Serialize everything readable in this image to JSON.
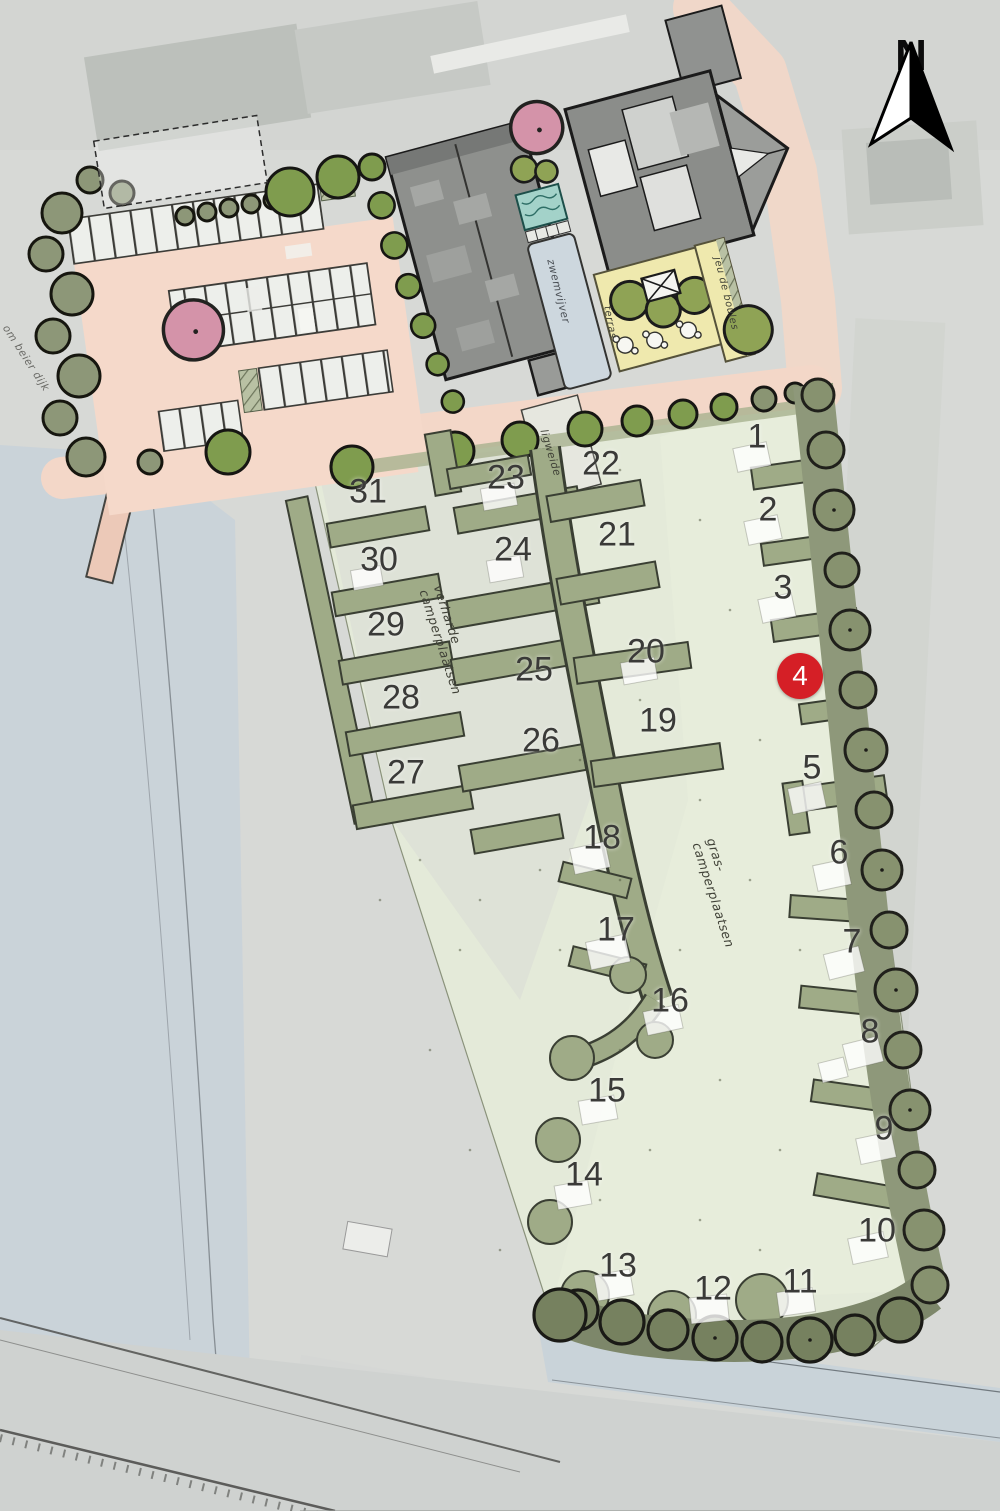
{
  "plan": {
    "compass_label": "N",
    "selected_pitch": "4",
    "pitch_numbers": [
      "1",
      "2",
      "3",
      "4",
      "5",
      "6",
      "7",
      "8",
      "9",
      "10",
      "11",
      "12",
      "13",
      "14",
      "15",
      "16",
      "17",
      "18",
      "19",
      "20",
      "21",
      "22",
      "23",
      "24",
      "25",
      "26",
      "27",
      "28",
      "29",
      "30",
      "31"
    ],
    "labels": {
      "grass_area_line1": "gras-",
      "grass_area_line2": "camperplaatsen",
      "paved_area_line1": "verharde",
      "paved_area_line2": "camperplaatsen",
      "pool": "zwemvijver",
      "lawn": "ligweide",
      "terrace": "terras",
      "petanque": "jeu de boules",
      "road": "om beier dijk"
    },
    "colors": {
      "marker_red": "#d51f26",
      "grass_field": "#e4ead9",
      "hedge_olive": "#9fab87",
      "boundary_olive": "#86916f",
      "tree_green": "#7f9c4e",
      "paving_salmon": "#f3d7c8",
      "building_gray": "#8e908d",
      "water_blue": "#c8d1d9",
      "terrace_yellow": "#efe9ae",
      "ornamental_pink": "#d493a9"
    }
  }
}
